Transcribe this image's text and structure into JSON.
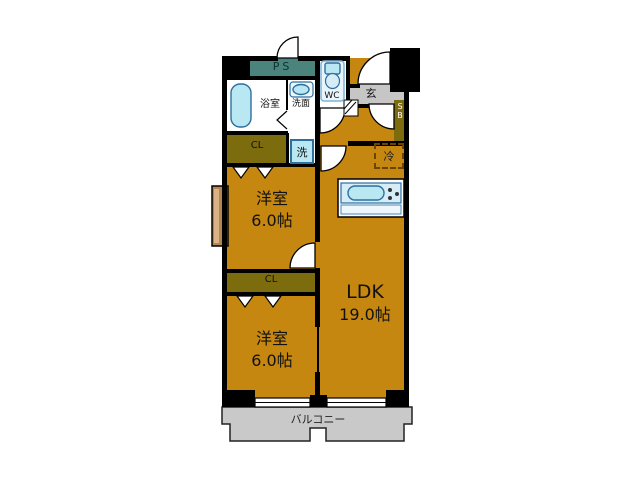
{
  "plan": {
    "ps_label": "PS",
    "bathroom_label": "浴室",
    "washroom_label": "洗面",
    "wc_label": "WC",
    "entrance_label": "玄",
    "shoebox_line1": "S",
    "shoebox_line2": "B",
    "closet1_label": "CL",
    "closet2_label": "CL",
    "laundry_label": "洗",
    "fridge_label": "冷",
    "room1": {
      "name": "洋室",
      "size": "6.0帖"
    },
    "room2": {
      "name": "洋室",
      "size": "6.0帖"
    },
    "ldk": {
      "name": "LDK",
      "size": "19.0帖"
    },
    "balcony_label": "バルコニー"
  },
  "colors": {
    "floor": "#c5870f",
    "closet": "#7d6c0e",
    "ps": "#4a847d",
    "entrance": "#c6c6c6",
    "balcony": "#c9c9c9",
    "fixture": "#b9e7f2",
    "fixture-light": "#d6edf8",
    "fixture-border": "#2d6f9e",
    "wall": "#000000",
    "bay": "#b5854f"
  }
}
